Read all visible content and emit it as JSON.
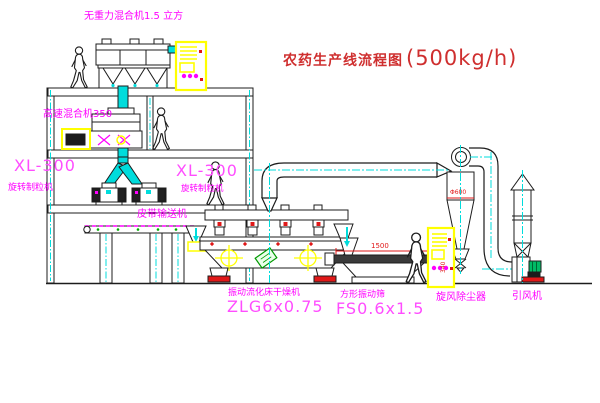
{
  "title": {
    "name": "农药生产线流程图",
    "capacity": "(500kg/h)"
  },
  "labels": {
    "gravity_free_mixer": "无重力混合机1.5 立方",
    "high_speed_mixer": "高速混合机350",
    "granulator_left_model": "XL-300",
    "granulator_left_name": "旋转制粒机",
    "granulator_right_model": "XL-300",
    "granulator_right_name": "旋转制粒机",
    "belt_conveyor": "皮带输送机",
    "dryer_name": "振动流化床干燥机",
    "dryer_model": "ZLG6x0.75",
    "screen_name": "方形振动筛",
    "screen_model": "FS0.6x1.5",
    "cyclone": "旋风除尘器",
    "fan": "引风机"
  },
  "dims": {
    "cyclone_diameter": "Φ600",
    "screen_length": "1500",
    "screen_height": "340"
  },
  "colors": {
    "label": "#ff00ff",
    "model": "#ff4dff",
    "title": "#cf2f2f",
    "dimension": "#e01818",
    "line": "#1c1c1c",
    "centerline": "#00dcdc",
    "highlight": "#ffff00"
  }
}
